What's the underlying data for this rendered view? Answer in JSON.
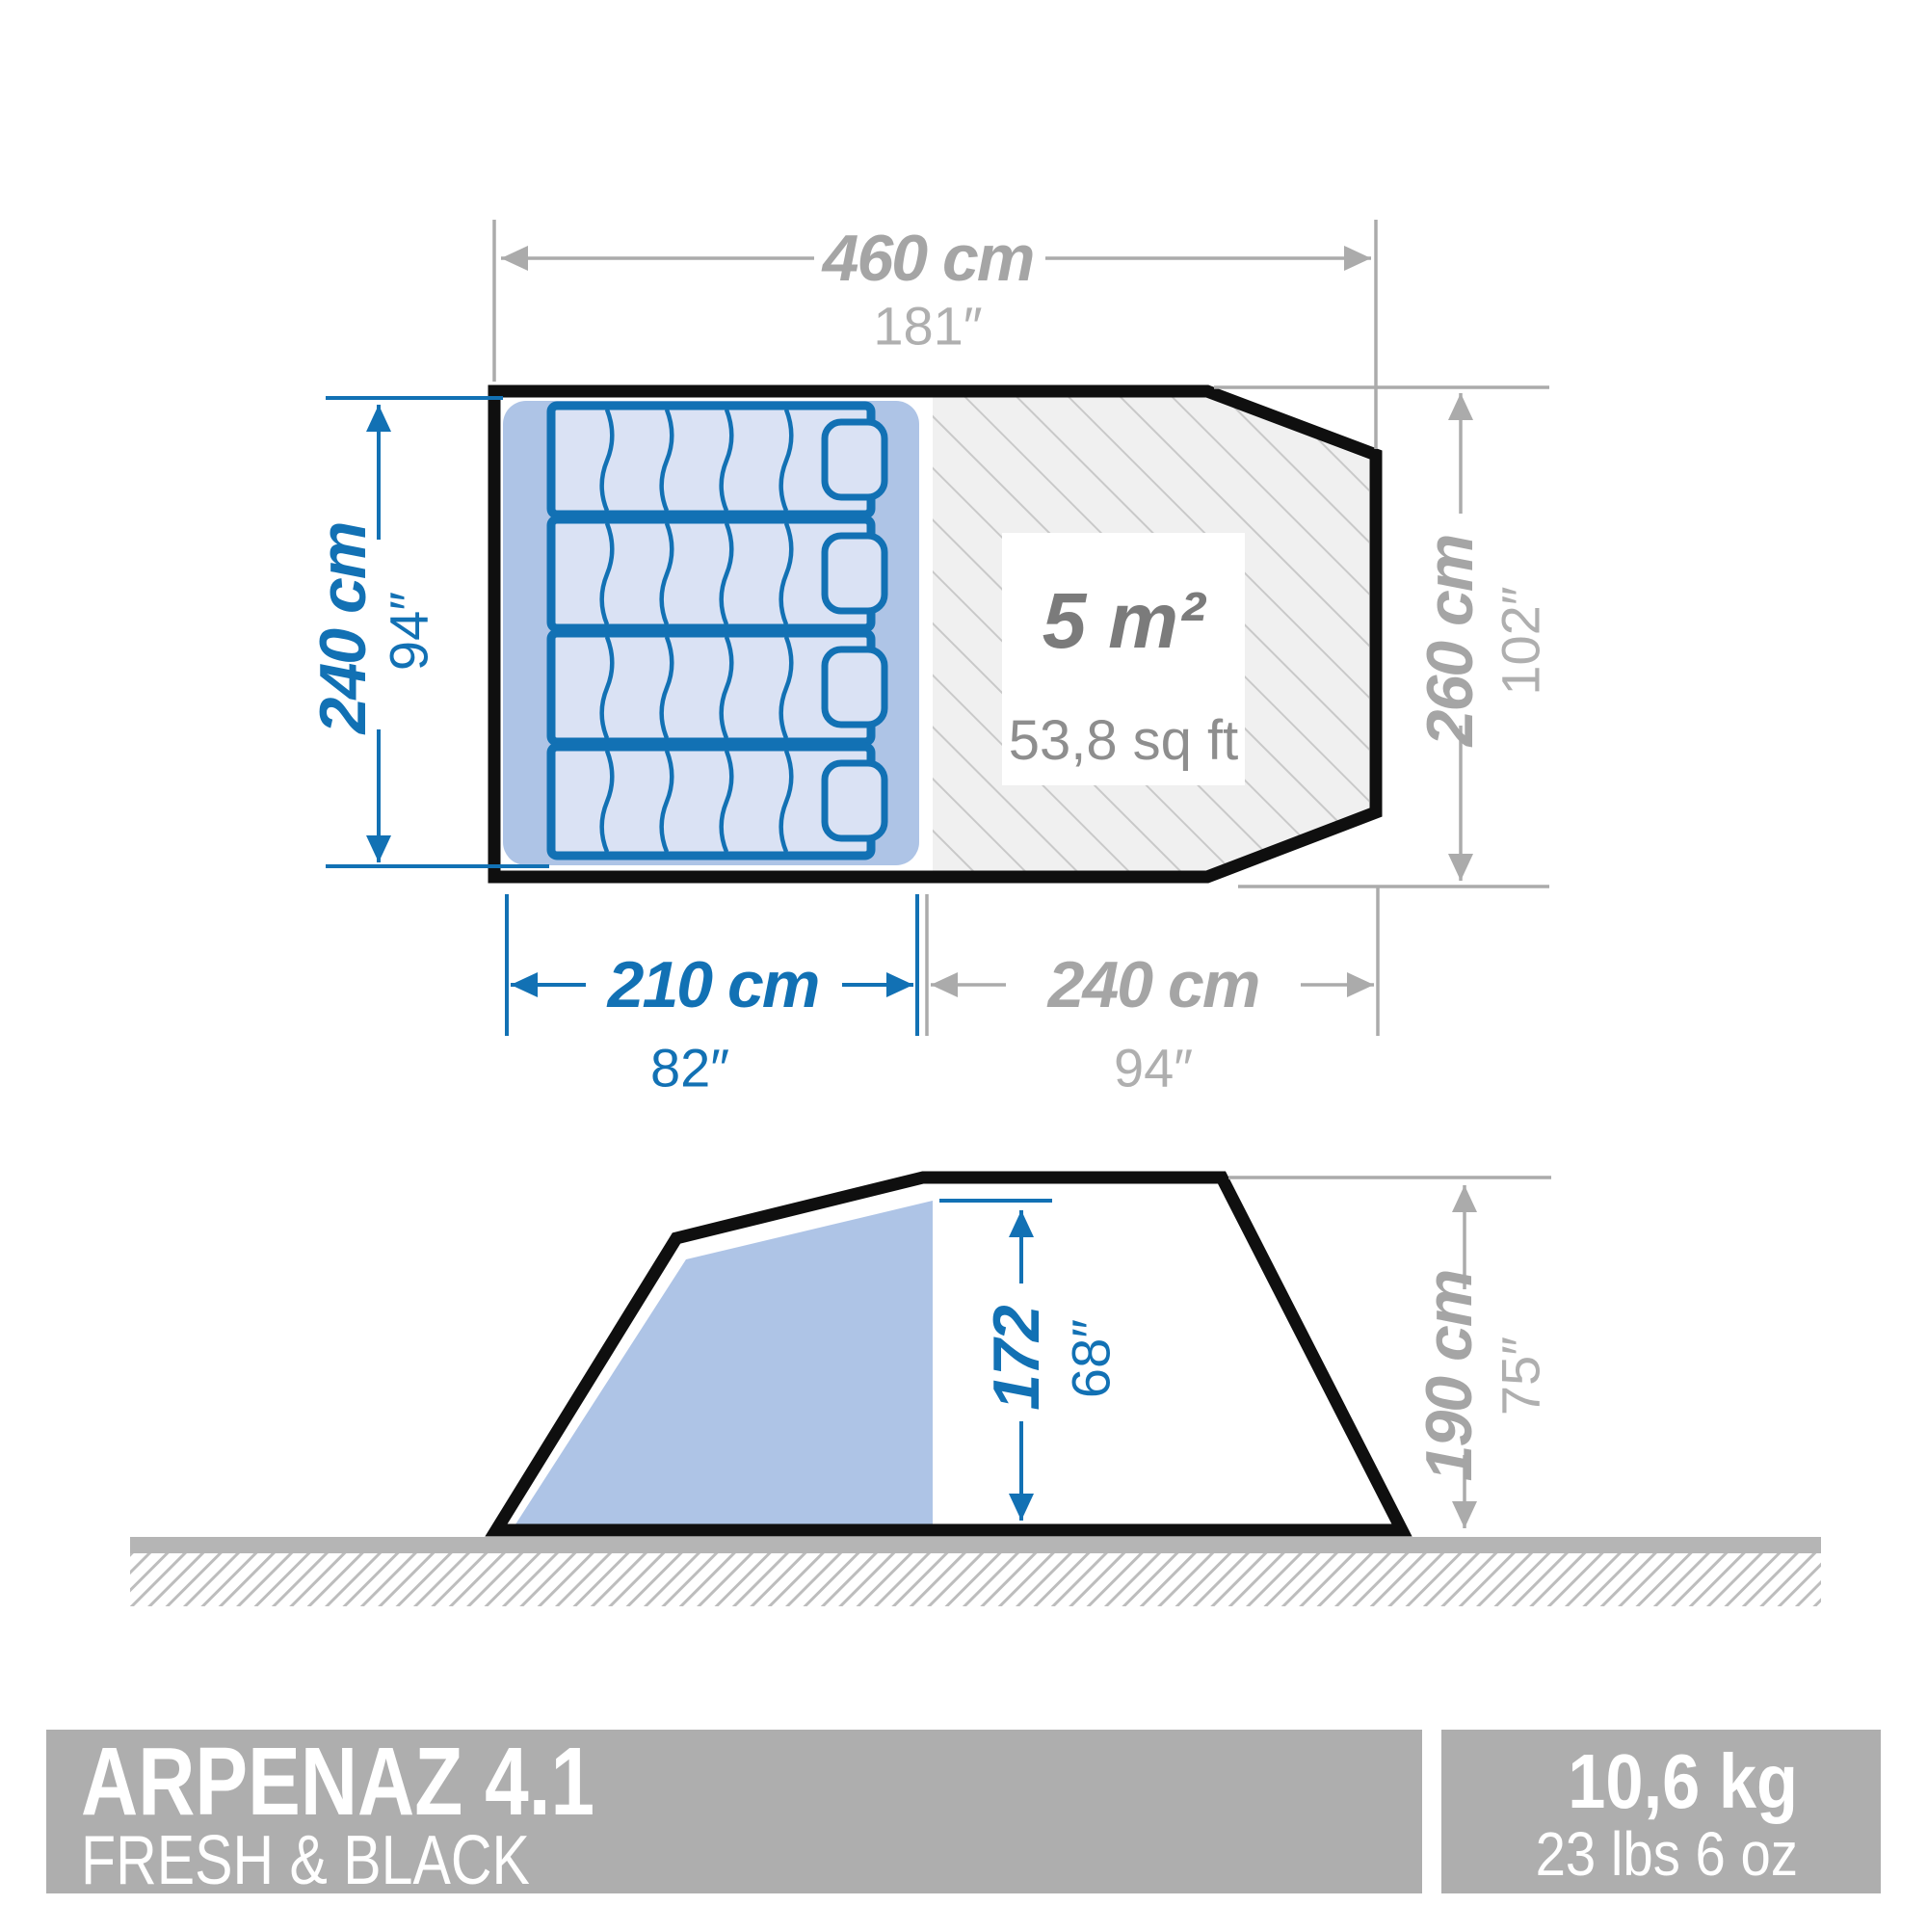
{
  "product": {
    "name": "ARPENAZ 4.1",
    "edition": "FRESH & BLACK"
  },
  "weight": {
    "metric": "10,6 kg",
    "imperial": "23 lbs 6 oz"
  },
  "top_view": {
    "total_length": {
      "cm": "460 cm",
      "in": "181″"
    },
    "bedroom_depth": {
      "cm": "240 cm",
      "in": "94″"
    },
    "total_depth": {
      "cm": "260 cm",
      "in": "102″"
    },
    "bedroom_length": {
      "cm": "210 cm",
      "in": "82″"
    },
    "living_length": {
      "cm": "240 cm",
      "in": "94″"
    },
    "living_area": {
      "m2": "5 m²",
      "sqft": "53,8 sq ft"
    }
  },
  "side_view": {
    "bedroom_height": {
      "cm": "172",
      "in": "68″"
    },
    "total_height": {
      "cm": "190 cm",
      "in": "75″"
    }
  },
  "colors": {
    "dimension_blue": "#1271B4",
    "dimension_gray": "#ABABAB",
    "bedroom_fill": "#AEC4E6",
    "mattress_fill": "#DAE2F4",
    "outline_black": "#0F0F0F",
    "footer_gray": "#AEAEAE"
  }
}
